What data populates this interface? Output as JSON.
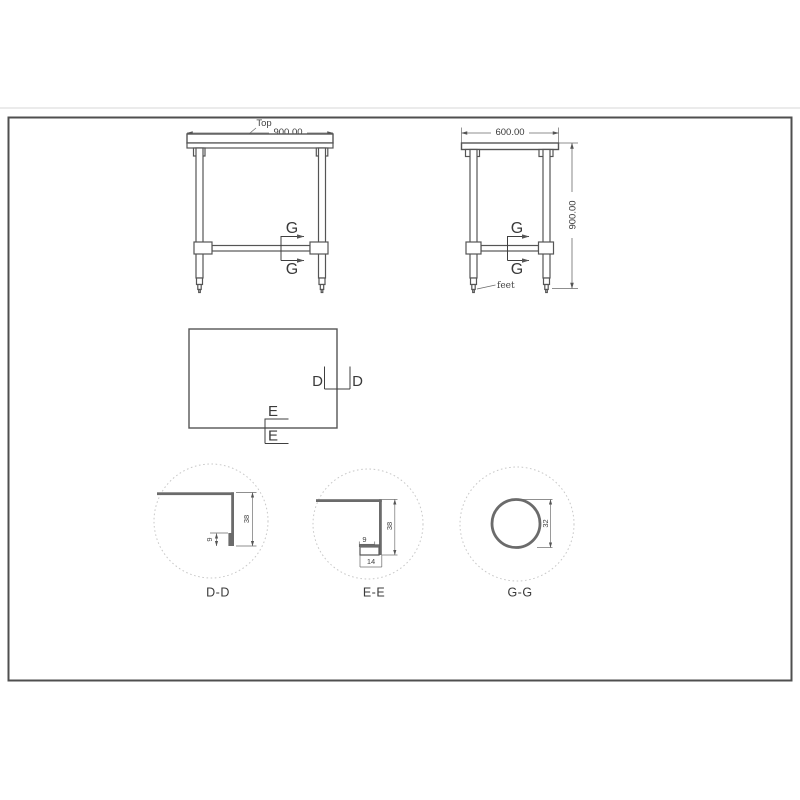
{
  "drawing": {
    "front_view": {
      "top_label": "Top",
      "width_dim": "900.00",
      "section_letter": "G"
    },
    "side_view": {
      "width_dim": "600.00",
      "height_dim": "900.00",
      "feet_label": "feet",
      "section_letter": "G"
    },
    "plan_view": {
      "section_d": "D",
      "section_e": "E"
    },
    "detail_dd": {
      "label": "D-D",
      "depth": "38",
      "hem": "9"
    },
    "detail_ee": {
      "label": "E-E",
      "depth": "38",
      "hem": "9",
      "fold": "14"
    },
    "detail_gg": {
      "label": "G-G",
      "tube_dia": "32"
    }
  },
  "colors": {
    "object_line": "#555555",
    "dim_line": "#6a6a6a",
    "text": "#3a3a3a",
    "detail_fill": "#6b6b6b",
    "dashed_circle": "#c8c8c8",
    "frame": "#4f4f4f",
    "page_rule": "#e6e6e6"
  }
}
